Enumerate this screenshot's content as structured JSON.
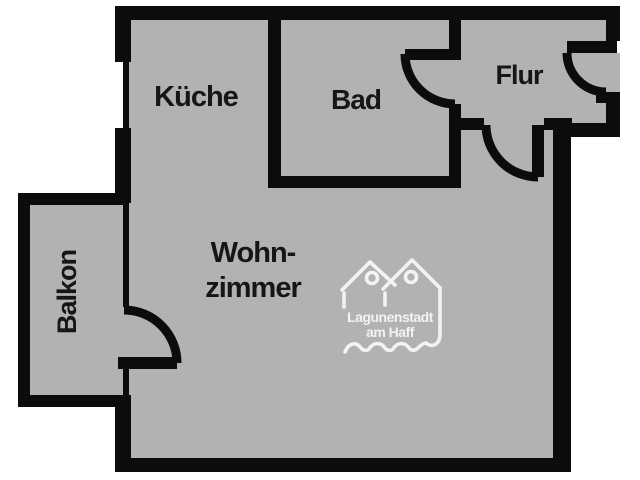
{
  "document": {
    "type": "apartment-floor-plan",
    "orientation": "top-down"
  },
  "colors": {
    "background": "#ffffff",
    "floor_fill": "#b2b2b0",
    "wall": "#0c0c0c",
    "label_text": "#161616",
    "logo": "#ffffff"
  },
  "rooms": {
    "kitchen": {
      "label": "Küche"
    },
    "bathroom": {
      "label": "Bad"
    },
    "hallway": {
      "label": "Flur"
    },
    "living_room": {
      "label_line1": "Wohn-",
      "label_line2": "zimmer"
    },
    "balcony": {
      "label": "Balkon"
    }
  },
  "doors": [
    {
      "name": "entry-door",
      "between": "outside-hallway"
    },
    {
      "name": "bathroom-door",
      "between": "hallway-bathroom"
    },
    {
      "name": "living-room-door",
      "between": "hallway-living-room"
    },
    {
      "name": "balcony-door",
      "between": "living-room-balcony"
    }
  ],
  "windows": [
    {
      "name": "kitchen-window",
      "wall": "left"
    },
    {
      "name": "balcony-window",
      "wall": "left"
    }
  ],
  "logo": {
    "name": "Lagunenstadt am Haff",
    "line1": "Lagunenstadt",
    "line2": "am Haff"
  }
}
